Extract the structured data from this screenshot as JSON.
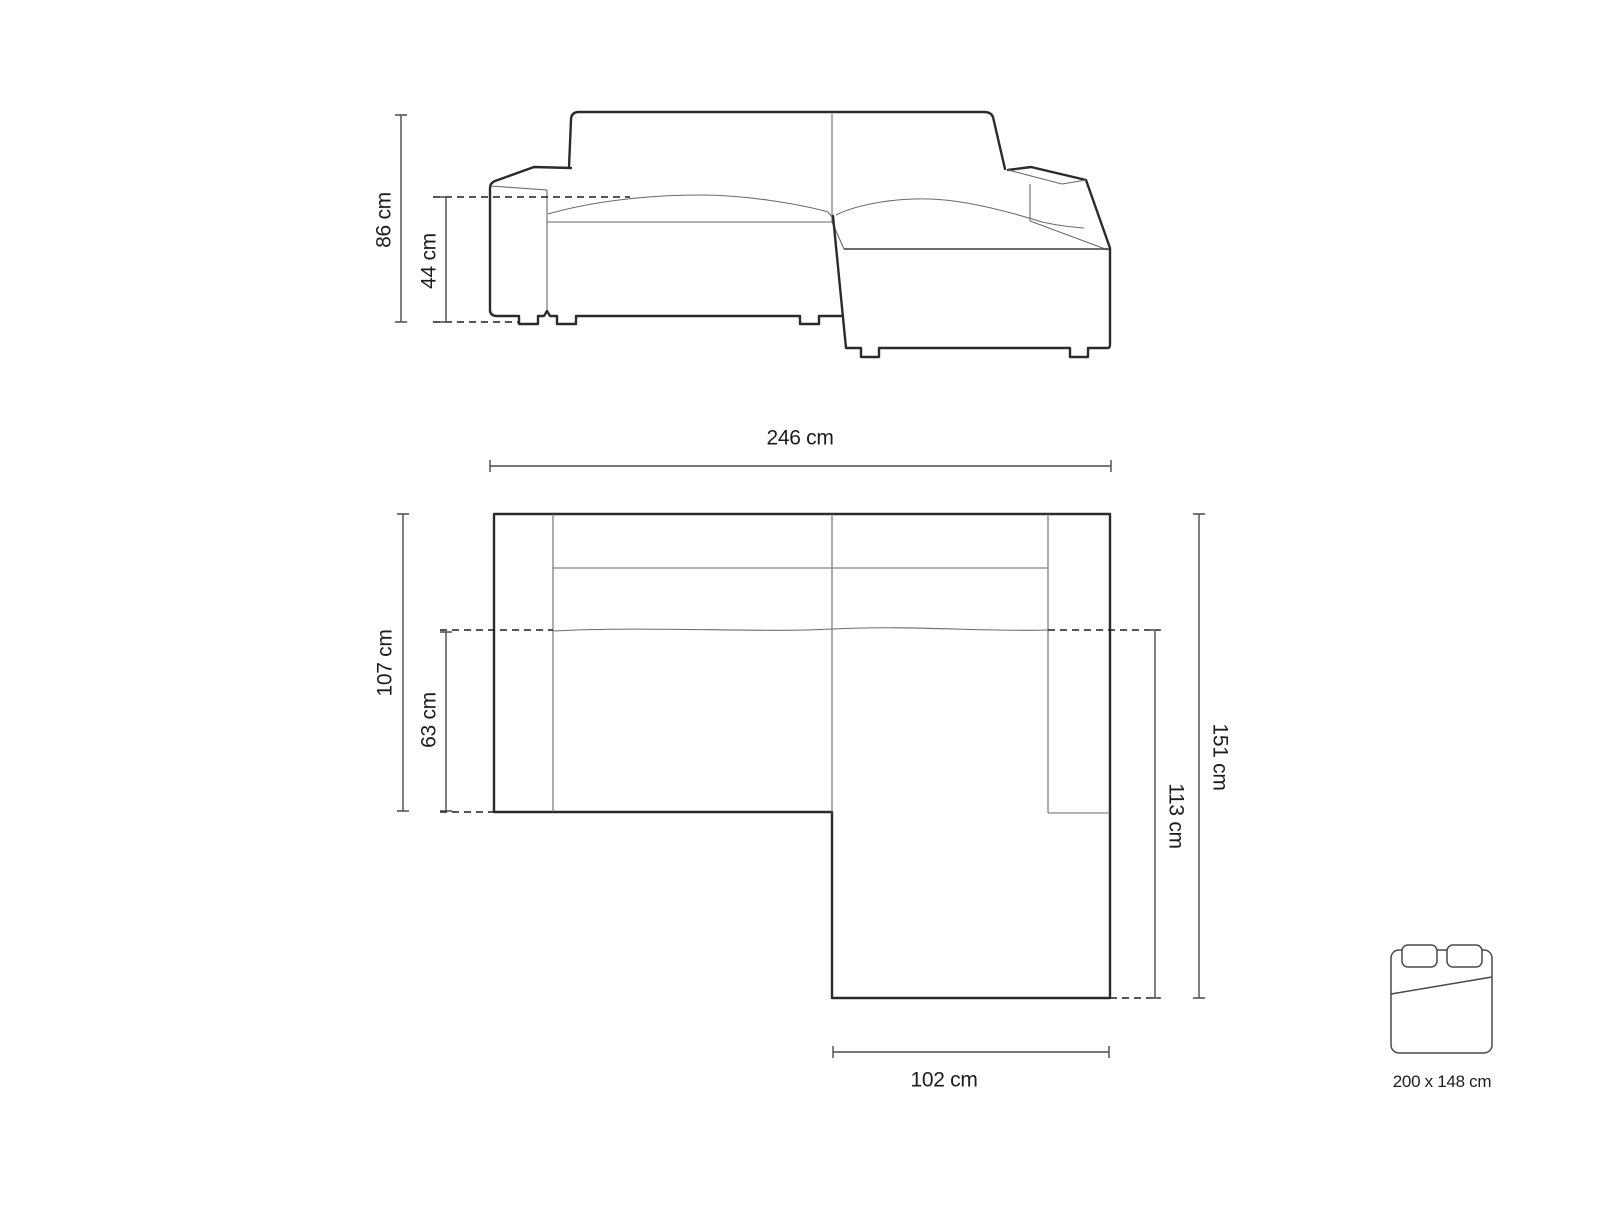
{
  "colors": {
    "background": "#ffffff",
    "outline": "#2b2b2b",
    "thin_line": "#6a6a6a",
    "dimension_line": "#4a4a4a",
    "text": "#1d1d1d"
  },
  "front_view": {
    "view": "front elevation of corner sofa",
    "dimensions": {
      "overall_height": "86 cm",
      "seat_height": "44 cm"
    }
  },
  "plan_view": {
    "view": "top plan of corner sofa with chaise",
    "dimensions": {
      "overall_width": "246 cm",
      "overall_depth": "107 cm",
      "seat_depth": "63 cm",
      "side_total_depth": "151 cm",
      "chaise_depth": "113 cm",
      "chaise_width": "102 cm"
    }
  },
  "sleeping_area": {
    "icon": "bed-mattress-with-pillows",
    "label": "200 x 148 cm"
  }
}
